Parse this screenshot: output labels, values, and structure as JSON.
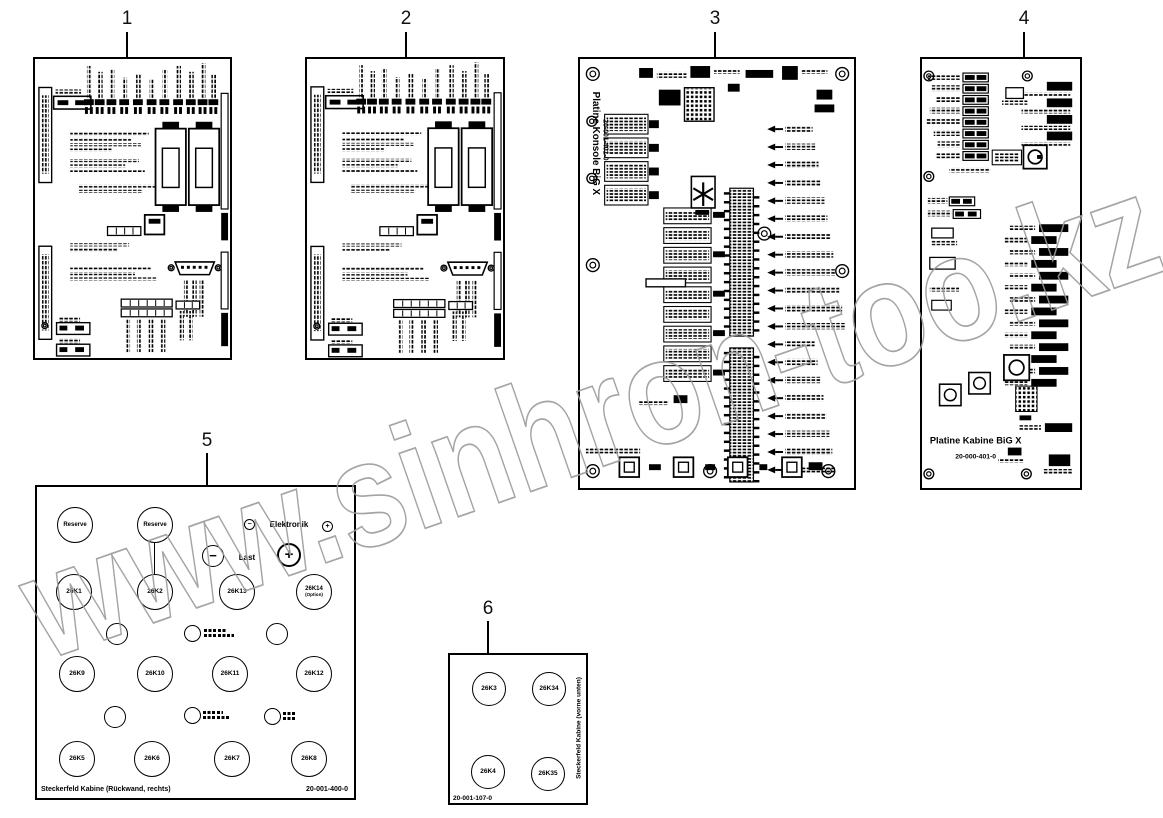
{
  "watermark": {
    "text": "www.sinhron-too.kz"
  },
  "callouts": {
    "n1": "1",
    "n2": "2",
    "n3": "3",
    "n4": "4",
    "n5": "5",
    "n6": "6"
  },
  "board3": {
    "title": "Platine Konsole BiG X",
    "part_number": "20-001-401-0"
  },
  "board4": {
    "title": "Platine Kabine BiG X",
    "part_number": "20-000-401-0"
  },
  "board5": {
    "reserve_top_left": "Reserve",
    "reserve_top_mid": "Reserve",
    "electronics_minus": "−",
    "electronics_label": "Elektronik",
    "electronics_plus": "+",
    "load_minus": "−",
    "load_label": "Last",
    "load_plus": "+",
    "relays": {
      "k1": "26K1",
      "k2": "26K2",
      "k13": "26K13",
      "k14": "26K14",
      "k14_sub": "(Option)",
      "k9": "26K9",
      "k10": "26K10",
      "k11": "26K11",
      "k12": "26K12",
      "k5": "26K5",
      "k6": "26K6",
      "k7": "26K7",
      "k8": "26K8"
    },
    "footer_label": "Steckerfeld Kabine (Rückwand, rechts)",
    "part_number": "20-001-400-0"
  },
  "board6": {
    "relays": {
      "k3": "26K3",
      "k34": "26K34",
      "k4": "26K4",
      "k35": "26K35"
    },
    "side_label": "Steckerfeld Kabine (vorne unten)",
    "part_number": "20-001-107-0"
  }
}
